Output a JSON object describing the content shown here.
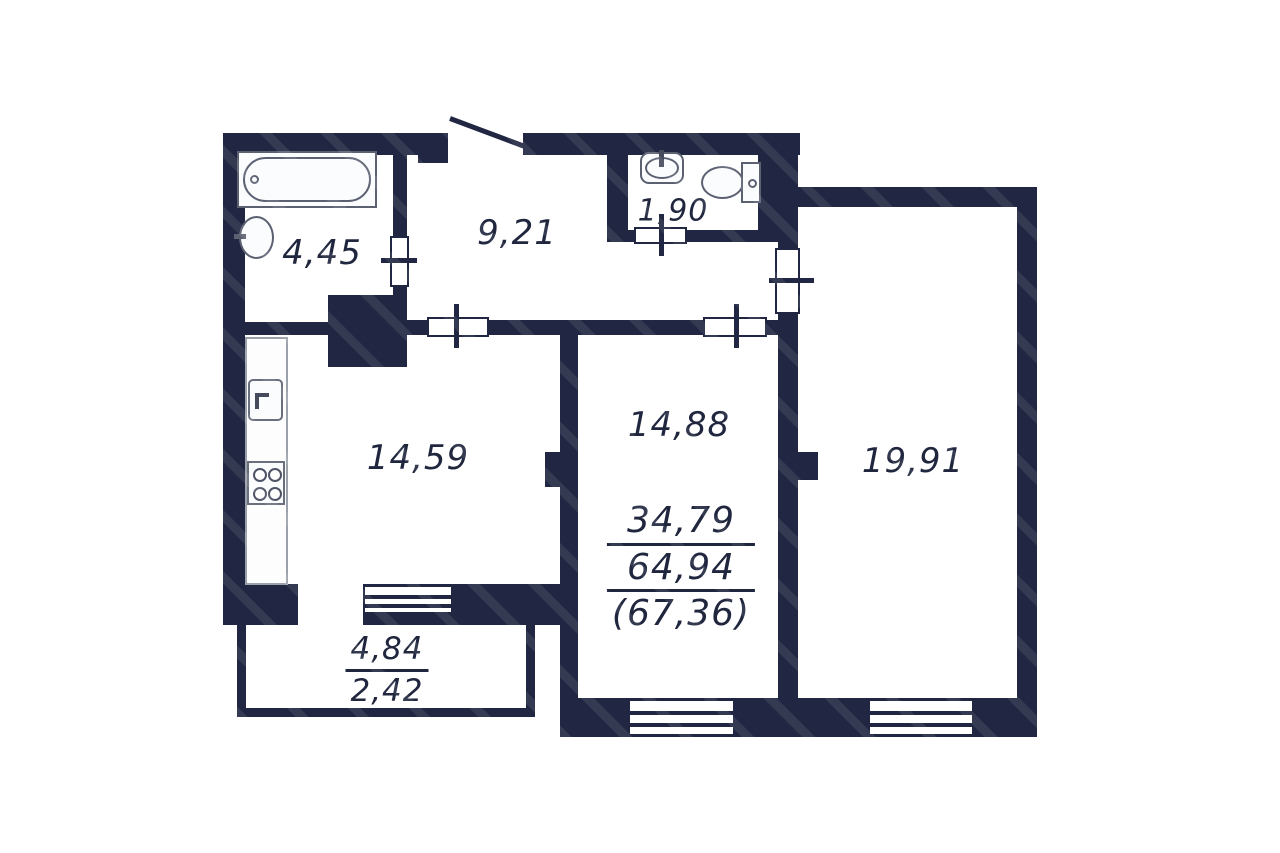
{
  "floorplan": {
    "type": "apartment-floor-plan",
    "wall_color": "#212742",
    "text_color": "#20263e",
    "rooms": {
      "bathroom": {
        "area": "4,45",
        "fixtures": [
          "bathtub-icon",
          "sink-icon"
        ]
      },
      "hallway": {
        "area": "9,21",
        "fixtures": [
          "entrance-door"
        ]
      },
      "wc": {
        "area": "1,90",
        "fixtures": [
          "sink-icon",
          "toilet-icon"
        ]
      },
      "kitchen": {
        "area": "14,59",
        "fixtures": [
          "kitchen-sink-icon",
          "stove-icon",
          "counter"
        ]
      },
      "room_middle": {
        "area": "14,88"
      },
      "room_right": {
        "area": "19,91"
      },
      "balcony": {
        "area_full": "4,84",
        "area_with_coefficient": "2,42"
      }
    },
    "area_summary": {
      "living_area": "34,79",
      "apartment_area": "64,94",
      "total_area": "(67,36)"
    }
  }
}
